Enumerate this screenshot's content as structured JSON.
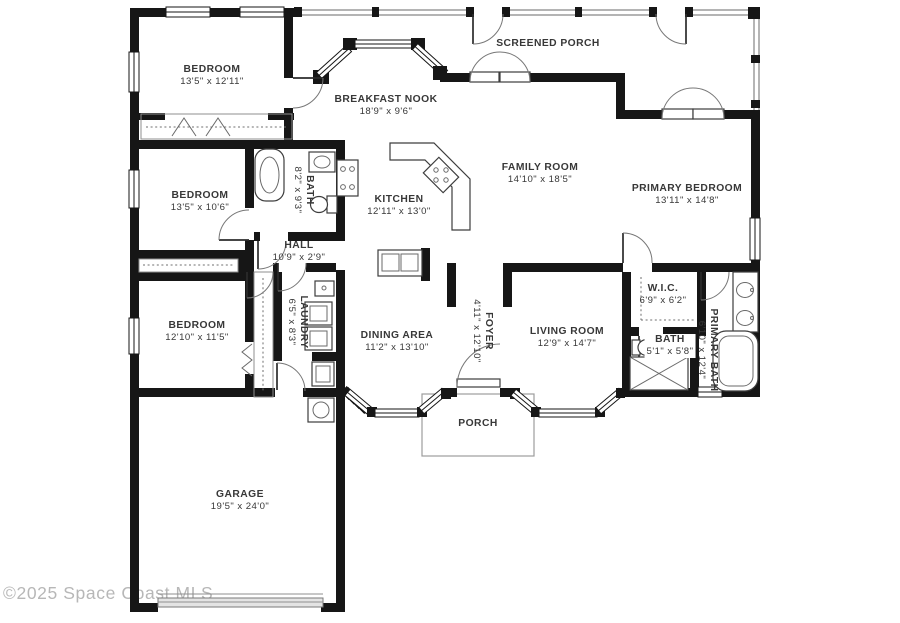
{
  "title": "Residential floor plan",
  "rooms": {
    "bedroom1": {
      "name": "BEDROOM",
      "dims": "13'5\" x 12'11\""
    },
    "screened_porch": {
      "name": "SCREENED PORCH",
      "dims": ""
    },
    "breakfast_nook": {
      "name": "BREAKFAST NOOK",
      "dims": "18'9\" x 9'6\""
    },
    "family_room": {
      "name": "FAMILY ROOM",
      "dims": "14'10\" x 18'5\""
    },
    "primary_bedroom": {
      "name": "PRIMARY BEDROOM",
      "dims": "13'11\" x 14'8\""
    },
    "bedroom2": {
      "name": "BEDROOM",
      "dims": "13'5\" x 10'6\""
    },
    "bath1": {
      "name": "BATH",
      "dims": "8'2\" x 9'3\""
    },
    "kitchen": {
      "name": "KITCHEN",
      "dims": "12'11\" x 13'0\""
    },
    "hall": {
      "name": "HALL",
      "dims": "10'9\" x 2'9\""
    },
    "wic": {
      "name": "W.I.C.",
      "dims": "6'9\" x 6'2\""
    },
    "bedroom3": {
      "name": "BEDROOM",
      "dims": "12'10\" x 11'5\""
    },
    "laundry": {
      "name": "LAUNDRY",
      "dims": "6'5\" x 8'3\""
    },
    "dining": {
      "name": "DINING AREA",
      "dims": "11'2\" x 13'10\""
    },
    "foyer": {
      "name": "FOYER",
      "dims": "4'11\" x 12'10\""
    },
    "living": {
      "name": "LIVING ROOM",
      "dims": "12'9\" x 14'7\""
    },
    "bath2": {
      "name": "BATH",
      "dims": "5'1\" x 5'8\""
    },
    "primary_bath": {
      "name": "PRIMARY BATH",
      "dims": "6'10\" x 12'4\""
    },
    "porch": {
      "name": "PORCH",
      "dims": ""
    },
    "garage": {
      "name": "GARAGE",
      "dims": "19'5\" x 24'0\""
    }
  },
  "watermark": {
    "text": "©2025 Space Coast MLS"
  },
  "colors": {
    "wall": "#161616",
    "label_text": "#383838",
    "thin_line": "#8f8f8f",
    "watermark": "#b7b7b7",
    "background": "#ffffff"
  }
}
